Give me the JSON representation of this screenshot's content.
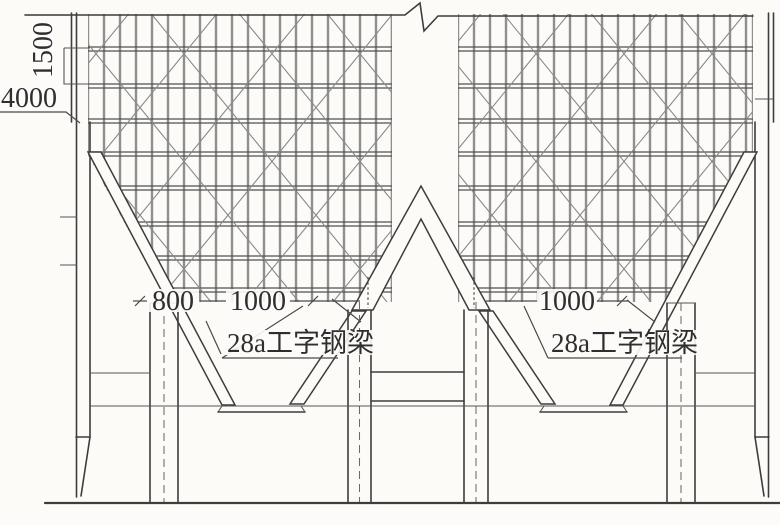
{
  "labels": {
    "dim_1500": "1500",
    "dim_4000": "4000",
    "dim_800": "800",
    "dim_1000_left": "1000",
    "dim_1000_right": "1000",
    "beam_label_left": "28a工字钢梁",
    "beam_label_right": "28a工字钢梁"
  },
  "colors": {
    "paper": "#fcfbf8",
    "ink": "#3d3d3d",
    "grid": "#8f8f8f"
  }
}
